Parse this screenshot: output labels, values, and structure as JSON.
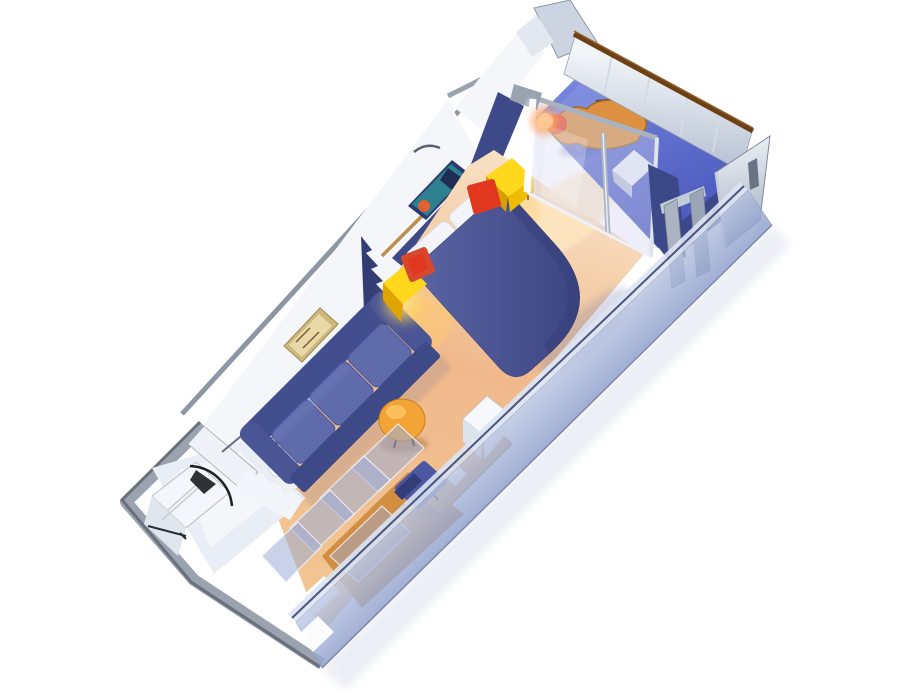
{
  "scene": {
    "type": "3d-cutaway-floorplan",
    "subject": "cruise-ship balcony stateroom, isometric cutaway render",
    "background": "#ffffff"
  },
  "labels": {
    "scene": "stateroom-3d-floorplan",
    "hull": "ship-hull-edge",
    "left_wall": "cabin-side-wall",
    "bathroom": "bathroom-with-shower-toilet-sink",
    "shower": "shower-stall",
    "toilet": "toilet",
    "sink": "pedestal-sink",
    "floor": "carpeted-floor",
    "entry": "entry-hall-wood-floor",
    "wardrobe": "wardrobe-glass-panels",
    "sofa": "blue-sofa",
    "divider": "navy-decorative-divider",
    "corner_table": "lit-corner-table",
    "nightstand": "yellow-nightstand",
    "stool_red": "red-stool-cushion",
    "bed": "queen-bed-with-pillows",
    "coffee_table": "round-orange-coffee-table",
    "tv": "tv-cabinet",
    "desk": "vanity-desk",
    "chair": "desk-chair",
    "glass_door": "balcony-sliding-glass-door",
    "balcony": "private-balcony",
    "lounger": "balcony-deck-lounger",
    "balcony_table": "balcony-side-table",
    "railing": "balcony-railing",
    "partition": "balcony-divider-partition",
    "corridor_wall": "corridor-side-cutaway-wall",
    "art_reef": "reef-wall-art",
    "art_gold": "gold-framed-wall-art"
  },
  "colors": {
    "bed_light": "#5b64a4",
    "bed_dark": "#39427e",
    "headboard": "#3d4988",
    "sofa_back": "#434e8e",
    "sofa_cushion": "#5f6bab",
    "sofa_front": "#3e4988",
    "carpet_light": "#f8dfc2",
    "carpet_mid": "#f0b98c",
    "carpet_warm": "#f2c492",
    "wood_floor": "#d08b3e",
    "table_yellow": "#ffd81e",
    "table_yellow_side": "#e0a400",
    "stool_red": "#e2371f",
    "coffee_orange": "#f2a437",
    "balcony_light": "#7585dc",
    "balcony_dark": "#4a59bd",
    "deck_chair": "#dd9140",
    "rail_brown": "#6b4012",
    "wall_white": "#f4f6f9",
    "wall_edge": "#8d96a2",
    "partition_navy": "#3c4888",
    "corridor_light": "#ccd5ec",
    "corridor_dark": "#8fa0cc",
    "fixture_white": "#fafbfd",
    "glow_yellow": "#ffd44d",
    "flare_orange": "#ff7a3d"
  }
}
